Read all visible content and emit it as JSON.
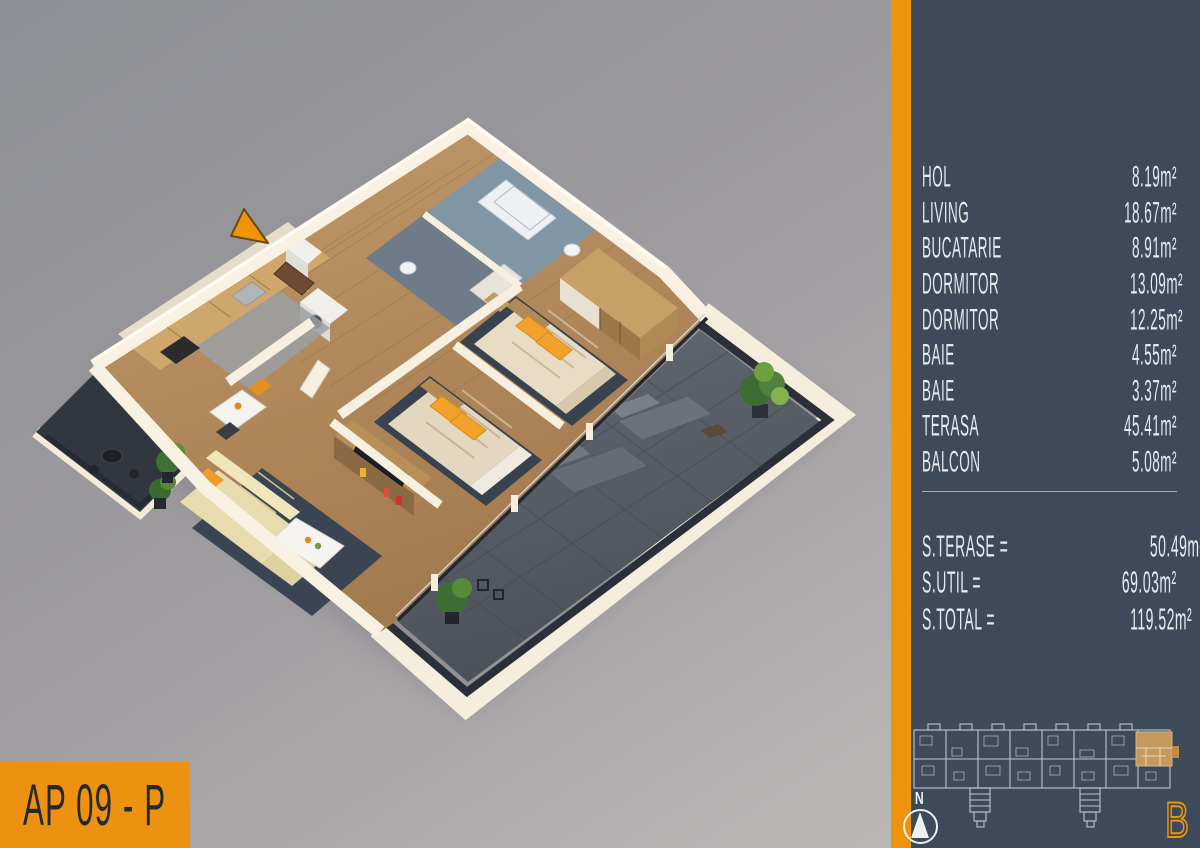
{
  "badge": {
    "label": "AP 09 - P"
  },
  "panel": {
    "rooms": [
      {
        "label": "HOL",
        "value": "8.19m²"
      },
      {
        "label": "LIVING",
        "value": "18.67m²"
      },
      {
        "label": "BUCATARIE",
        "value": "8.91m²"
      },
      {
        "label": "DORMITOR",
        "value": "13.09m²"
      },
      {
        "label": "DORMITOR",
        "value": "12.25m²"
      },
      {
        "label": "BAIE",
        "value": "4.55m²"
      },
      {
        "label": "BAIE",
        "value": "3.37m²"
      },
      {
        "label": "TERASA",
        "value": "45.41m²"
      },
      {
        "label": "BALCON",
        "value": "5.08m²"
      }
    ],
    "totals": [
      {
        "label": "S.TERASE =",
        "value": "50.49m²"
      },
      {
        "label": "S.UTIL =",
        "value": "69.03m²"
      },
      {
        "label": "S.TOTAL =",
        "value": "119.52m²"
      }
    ],
    "compass": {
      "north_label": "N"
    },
    "building_letter": "B"
  },
  "colors": {
    "accent_orange": "#ef9309",
    "panel_background": "#3d4a59",
    "panel_text": "#e4eaef",
    "highlight_unit": "#c49a5e",
    "terrace_floor": "#575d66",
    "wall_cream": "#f8f0e1"
  }
}
